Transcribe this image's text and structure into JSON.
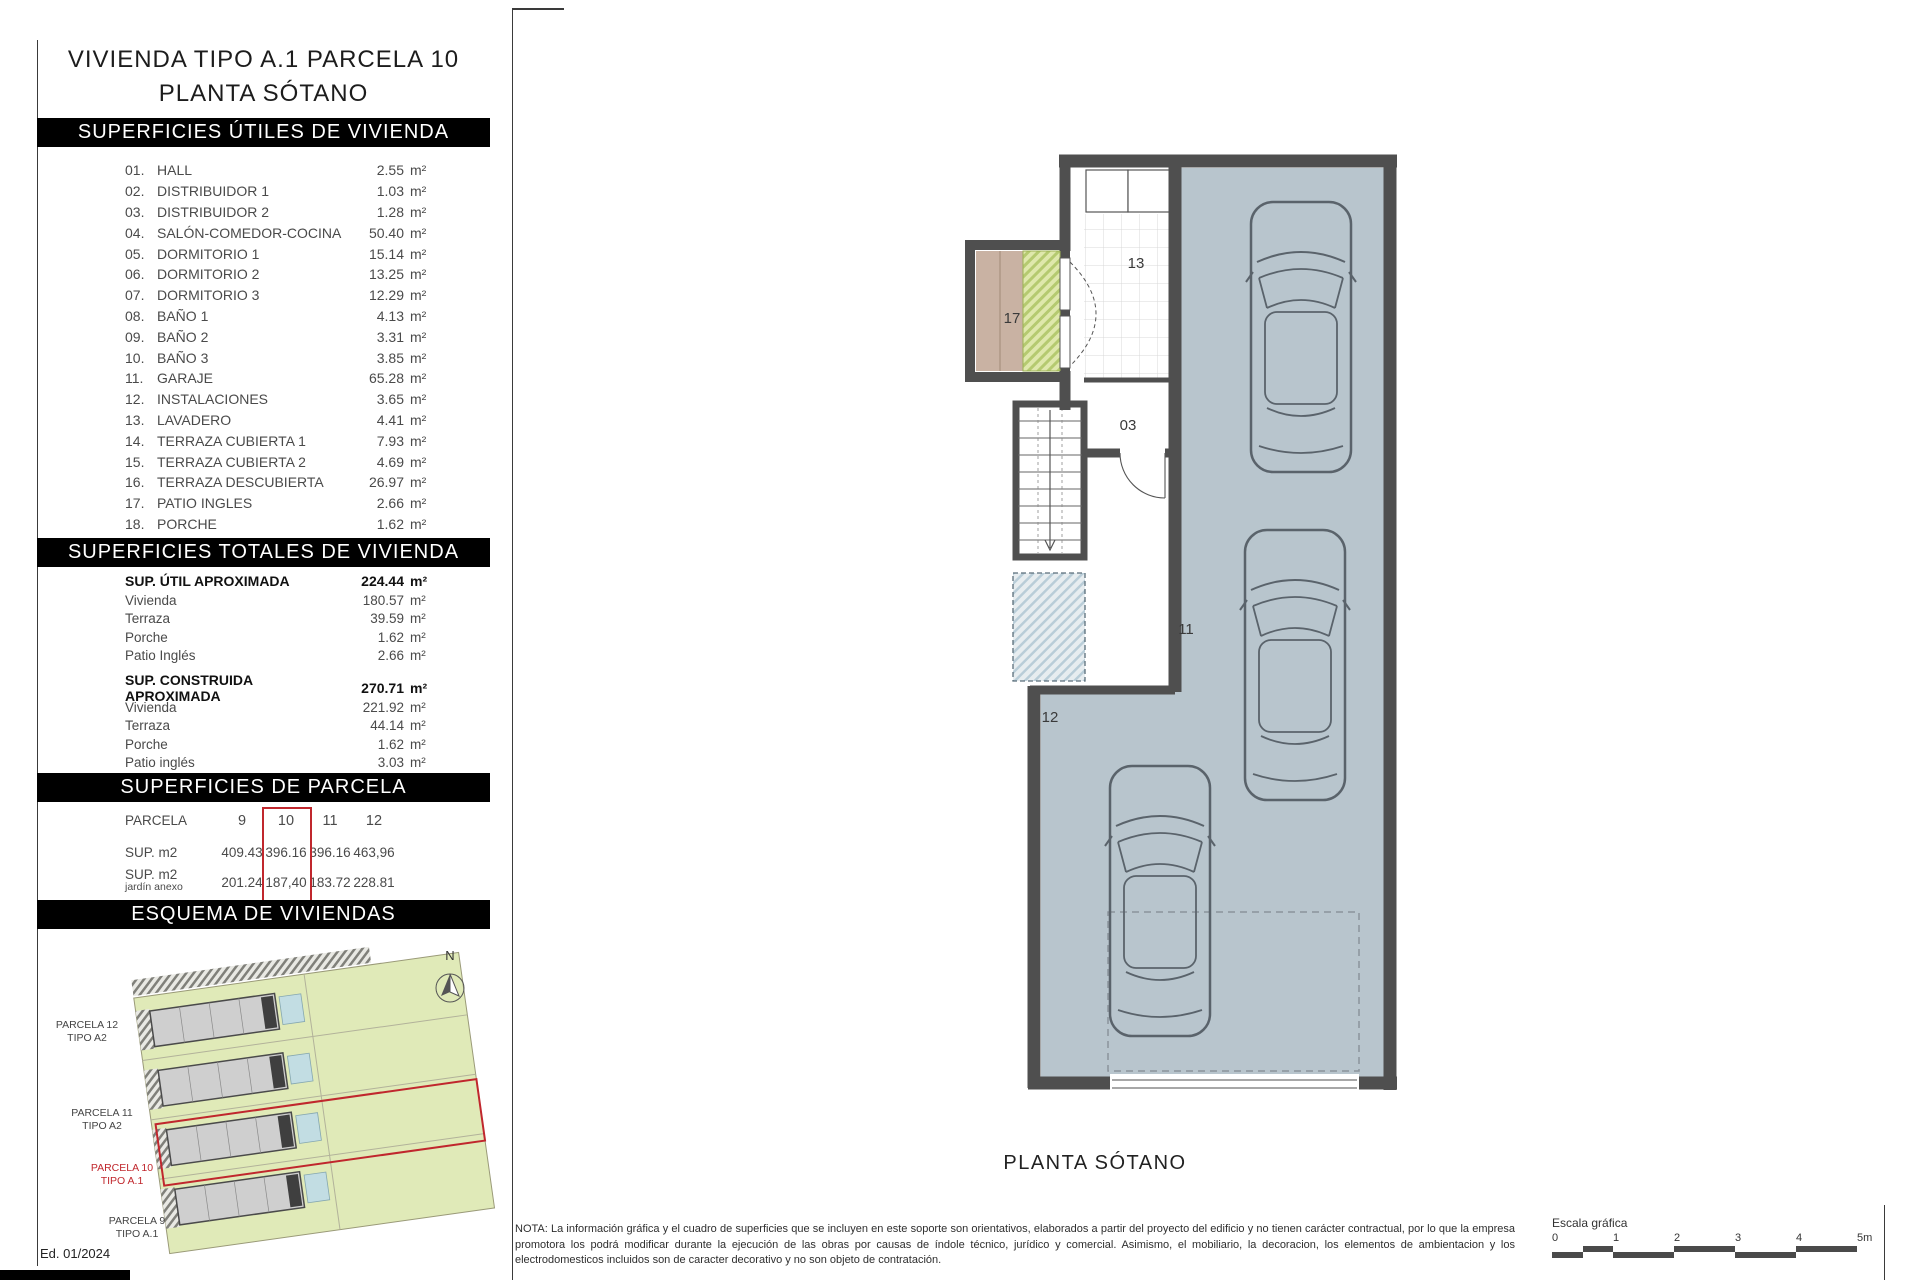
{
  "title": {
    "line1": "VIVIENDA TIPO A.1 PARCELA 10",
    "line2": "PLANTA SÓTANO"
  },
  "sections": {
    "utiles": {
      "header": "SUPERFICIES ÚTILES DE VIVIENDA",
      "rows": [
        {
          "num": "01.",
          "label": "HALL",
          "value": "2.55",
          "unit": "m²"
        },
        {
          "num": "02.",
          "label": "DISTRIBUIDOR 1",
          "value": "1.03",
          "unit": "m²"
        },
        {
          "num": "03.",
          "label": "DISTRIBUIDOR 2",
          "value": "1.28",
          "unit": "m²"
        },
        {
          "num": "04.",
          "label": "SALÓN-COMEDOR-COCINA",
          "value": "50.40",
          "unit": "m²"
        },
        {
          "num": "05.",
          "label": "DORMITORIO 1",
          "value": "15.14",
          "unit": "m²"
        },
        {
          "num": "06.",
          "label": "DORMITORIO 2",
          "value": "13.25",
          "unit": "m²"
        },
        {
          "num": "07.",
          "label": "DORMITORIO 3",
          "value": "12.29",
          "unit": "m²"
        },
        {
          "num": "08.",
          "label": "BAÑO 1",
          "value": "4.13",
          "unit": "m²"
        },
        {
          "num": "09.",
          "label": "BAÑO 2",
          "value": "3.31",
          "unit": "m²"
        },
        {
          "num": "10.",
          "label": "BAÑO 3",
          "value": "3.85",
          "unit": "m²"
        },
        {
          "num": "11.",
          "label": "GARAJE",
          "value": "65.28",
          "unit": "m²"
        },
        {
          "num": "12.",
          "label": "INSTALACIONES",
          "value": "3.65",
          "unit": "m²"
        },
        {
          "num": "13.",
          "label": "LAVADERO",
          "value": "4.41",
          "unit": "m²"
        },
        {
          "num": "14.",
          "label": "TERRAZA CUBIERTA 1",
          "value": "7.93",
          "unit": "m²"
        },
        {
          "num": "15.",
          "label": "TERRAZA CUBIERTA 2",
          "value": "4.69",
          "unit": "m²"
        },
        {
          "num": "16.",
          "label": "TERRAZA DESCUBIERTA",
          "value": "26.97",
          "unit": "m²"
        },
        {
          "num": "17.",
          "label": "PATIO INGLES",
          "value": "2.66",
          "unit": "m²"
        },
        {
          "num": "18.",
          "label": "PORCHE",
          "value": "1.62",
          "unit": "m²"
        }
      ]
    },
    "totales": {
      "header": "SUPERFICIES TOTALES DE VIVIENDA",
      "groups": [
        {
          "title": "SUP. ÚTIL APROXIMADA",
          "value": "224.44",
          "unit": "m²",
          "rows": [
            {
              "label": "Vivienda",
              "value": "180.57",
              "unit": "m²"
            },
            {
              "label": "Terraza",
              "value": "39.59",
              "unit": "m²"
            },
            {
              "label": "Porche",
              "value": "1.62",
              "unit": "m²"
            },
            {
              "label": "Patio Inglés",
              "value": "2.66",
              "unit": "m²"
            }
          ]
        },
        {
          "title": "SUP. CONSTRUIDA APROXIMADA",
          "value": "270.71",
          "unit": "m²",
          "rows": [
            {
              "label": "Vivienda",
              "value": "221.92",
              "unit": "m²"
            },
            {
              "label": "Terraza",
              "value": "44.14",
              "unit": "m²"
            },
            {
              "label": "Porche",
              "value": "1.62",
              "unit": "m²"
            },
            {
              "label": "Patio inglés",
              "value": "3.03",
              "unit": "m²"
            }
          ]
        }
      ]
    },
    "parcela": {
      "header": "SUPERFICIES DE PARCELA",
      "row_label_parcela": "PARCELA",
      "row_label_sup": "SUP. m2",
      "row_label_jardin": "SUP. m2",
      "row_sublabel_jardin": "jardín anexo",
      "columns": [
        {
          "id": "9",
          "sup": "409.43",
          "jardin": "201.24"
        },
        {
          "id": "10",
          "sup": "396.16",
          "jardin": "187,40"
        },
        {
          "id": "11",
          "sup": "396.16",
          "jardin": "183.72"
        },
        {
          "id": "12",
          "sup": "463,96",
          "jardin": "228.81"
        }
      ],
      "highlighted_column": "10",
      "highlight_color": "#c0272d"
    },
    "esquema": {
      "header": "ESQUEMA DE VIVIENDAS",
      "north_label": "N",
      "labels": [
        {
          "line1": "PARCELA 12",
          "line2": "TIPO A2",
          "highlight": false
        },
        {
          "line1": "PARCELA 11",
          "line2": "TIPO A2",
          "highlight": false
        },
        {
          "line1": "PARCELA 10",
          "line2": "TIPO A.1",
          "highlight": true
        },
        {
          "line1": "PARCELA 9",
          "line2": "TIPO A.1",
          "highlight": false
        }
      ]
    }
  },
  "plan": {
    "caption": "PLANTA SÓTANO",
    "rooms": {
      "patio": "17",
      "lavadero": "13",
      "distribuidor": "03",
      "garaje": "11",
      "instalaciones": "12"
    },
    "colors": {
      "garage_fill": "#b8c5cd",
      "wall": "#4f4f4f",
      "patio_tan": "#c9b2a3",
      "hatch_green": "#b5ca70",
      "hatch_blue": "#b9cdd8",
      "highlight": "#c0272d"
    }
  },
  "footer": {
    "edition": "Ed. 01/2024",
    "nota": "NOTA: La información gráfica y el cuadro de superficies que se incluyen en este soporte son orientativos, elaborados a partir del proyecto del edificio y no tienen carácter contractual, por lo que la empresa promotora los podrá modificar durante la ejecución de las obras por causas de índole técnico, jurídico y comercial. Asimismo, el mobiliario, la decoracion, los elementos de ambientacion y los electrodomesticos incluidos son de caracter decorativo y no son objeto de contratación.",
    "scale": {
      "label": "Escala gráfica",
      "ticks": [
        "0",
        "1",
        "2",
        "3",
        "4",
        "5m"
      ]
    }
  }
}
